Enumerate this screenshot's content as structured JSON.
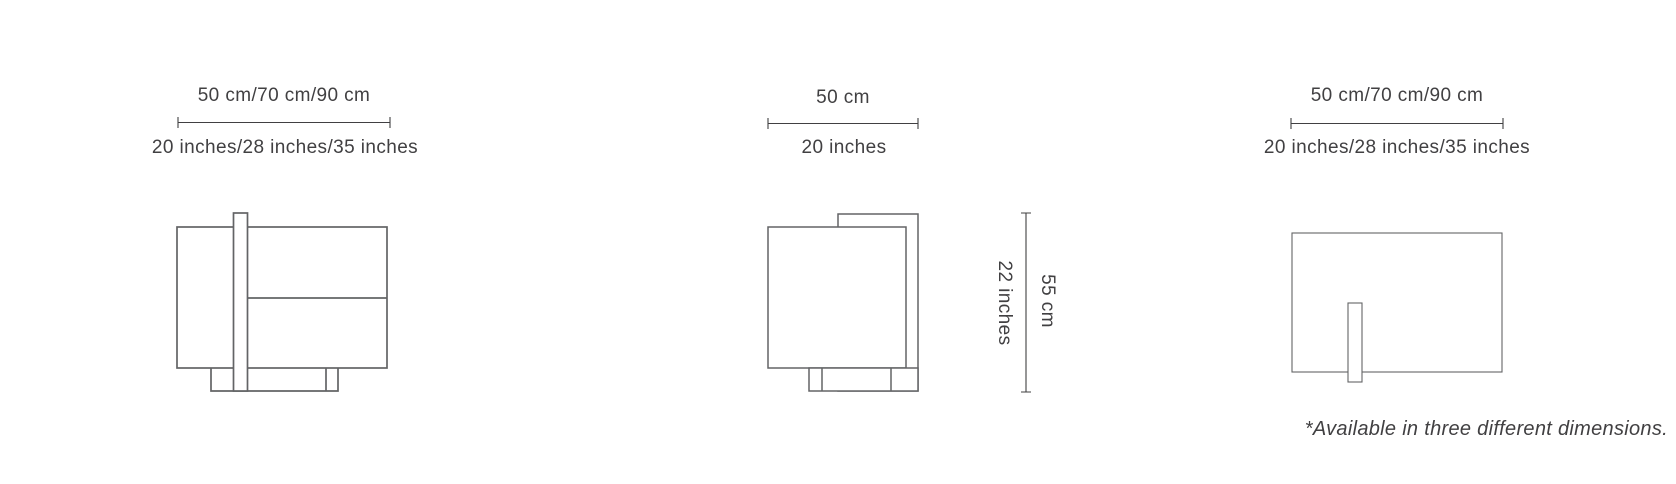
{
  "colors": {
    "line": "#636466",
    "text": "#414042",
    "background": "#ffffff"
  },
  "footnote": "*Available in three different dimensions.",
  "views": {
    "front": {
      "width_cm": "50 cm/70 cm/90 cm",
      "width_inches": "20 inches/28 inches/35 inches"
    },
    "side": {
      "width_cm": "50 cm",
      "width_inches": "20 inches",
      "height_cm": "55 cm",
      "height_inches": "22 inches"
    },
    "top": {
      "width_cm": "50 cm/70 cm/90 cm",
      "width_inches": "20 inches/28 inches/35 inches"
    }
  }
}
